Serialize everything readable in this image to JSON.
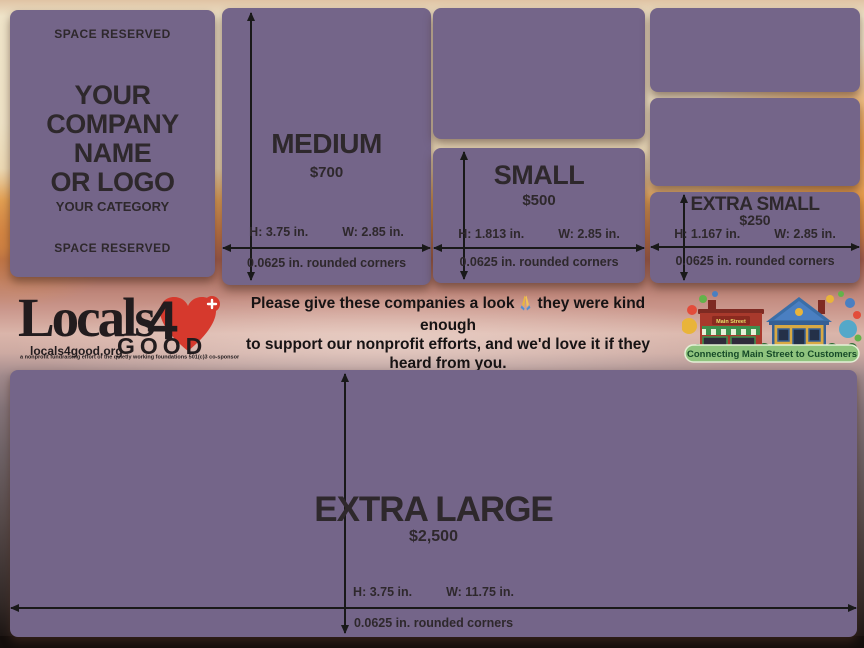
{
  "cards": {
    "company": {
      "space_reserved_top": "SPACE RESERVED",
      "line1": "YOUR",
      "line2": "COMPANY",
      "line3": "NAME",
      "line4": "OR LOGO",
      "category": "YOUR CATEGORY",
      "space_reserved_bottom": "SPACE RESERVED"
    },
    "medium": {
      "title": "MEDIUM",
      "price": "$700",
      "h_label": "H: 3.75 in.",
      "w_label": "W: 2.85 in.",
      "corners": "0.0625 in. rounded corners"
    },
    "small": {
      "title": "SMALL",
      "price": "$500",
      "h_label": "H: 1.813 in.",
      "w_label": "W: 2.85 in.",
      "corners": "0.0625 in. rounded corners"
    },
    "extra_small": {
      "title": "EXTRA SMALL",
      "price": "$250",
      "h_label": "H: 1.167 in.",
      "w_label": "W: 2.85 in.",
      "corners": "0.0625 in. rounded corners"
    },
    "extra_large": {
      "title": "EXTRA LARGE",
      "price": "$2,500",
      "h_label": "H: 3.75 in.",
      "w_label": "W: 11.75 in.",
      "corners": "0.0625 in. rounded corners"
    }
  },
  "brand": {
    "word_locals": "Locals",
    "word_four": "4",
    "word_good": "GOOD",
    "website": "locals4good.org",
    "tagline": "a nonprofit fundraising effort of the quietly working foundations 501(c)3 co-sponsor"
  },
  "message": {
    "line1_before": "Please give these companies a look",
    "line1_after": "they were kind enough",
    "line2": "to support our nonprofit efforts, and we'd love it if they heard from you.",
    "line3": "Thank you <3"
  },
  "mainstreet": {
    "sign_label": "Main Street",
    "banner_label": "Connecting Main Street to Customers"
  },
  "colors": {
    "card_purple": "#746589",
    "heart_red": "#d6392d",
    "website_orange": "#d79d61",
    "banner_green": "#8fc47e",
    "banner_text_green": "#164a28"
  }
}
